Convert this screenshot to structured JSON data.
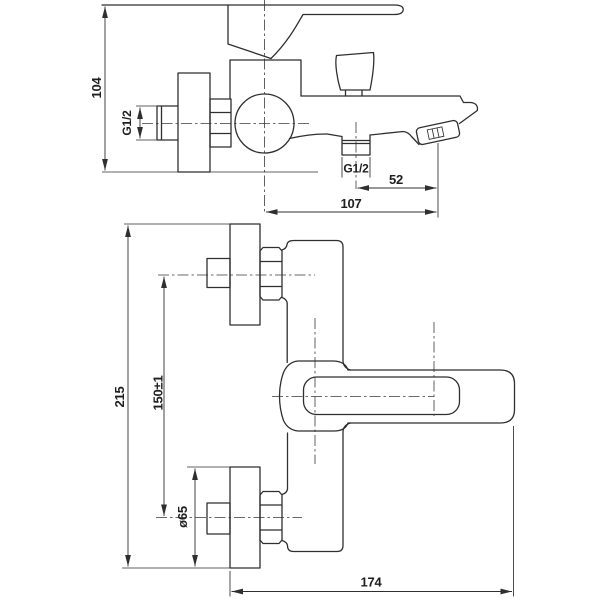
{
  "colors": {
    "line": "#2f2f2f",
    "text": "#1f1f1f",
    "background": "#ffffff"
  },
  "side_view": {
    "dim_height": "104",
    "wall_thread": "G1/2",
    "outlet_thread": "G1/2",
    "outlet_to_aerator": "52",
    "center_to_aerator": "107"
  },
  "front_view": {
    "overall_height": "215",
    "connection_spacing": "150±1",
    "escutcheon_diameter": "ø65",
    "overall_width": "174"
  }
}
